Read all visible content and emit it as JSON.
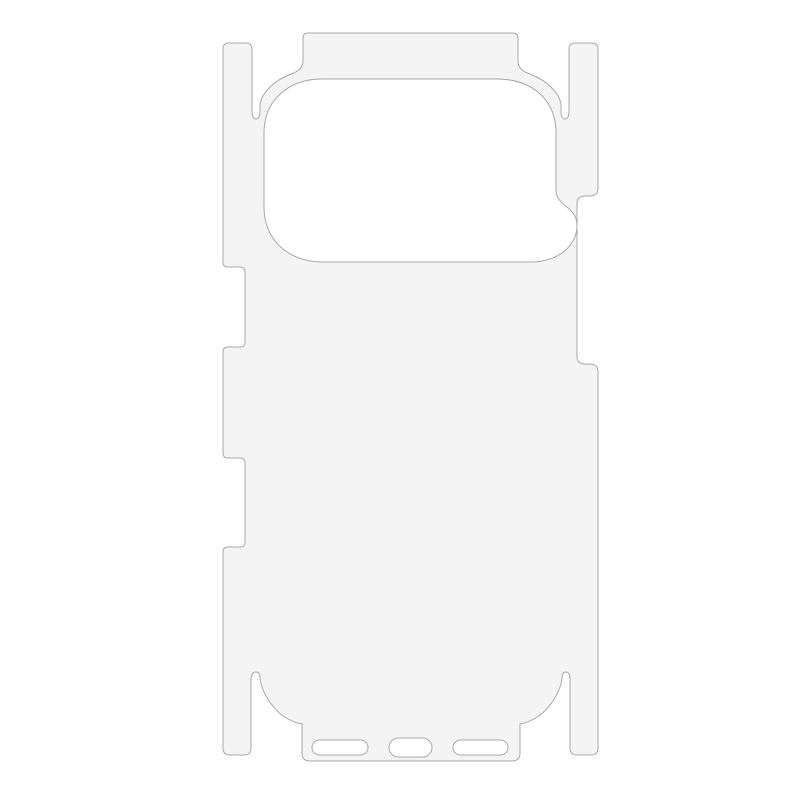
{
  "image": {
    "description": "Die-cut clear back film template for a smartphone: full back panel with large rounded camera cutout, top and bottom wrap flaps, left and right side wrap strips with button notches, corner cut slits, and three bottom port slots",
    "background_color": "#ffffff"
  },
  "film": {
    "fill_color": "#f4f4f5",
    "hole_fill_color": "#ffffff",
    "outline_color": "#a8a8a8",
    "outline_width": "1"
  },
  "parts": {
    "body": "film-body-outline",
    "camera_cutout": "camera-cutout",
    "top_flap": "top-edge-flap",
    "bottom_flap": "bottom-edge-flap",
    "left_strip": "left-side-wrap",
    "right_strip": "right-side-wrap",
    "left_notch_upper": "action-button-notch",
    "left_notch_lower": "volume-button-notch",
    "right_notch": "power-button-notch",
    "bottom_slot_left": "speaker-slot-left",
    "bottom_slot_center": "charging-port-slot",
    "bottom_slot_right": "speaker-slot-right"
  }
}
